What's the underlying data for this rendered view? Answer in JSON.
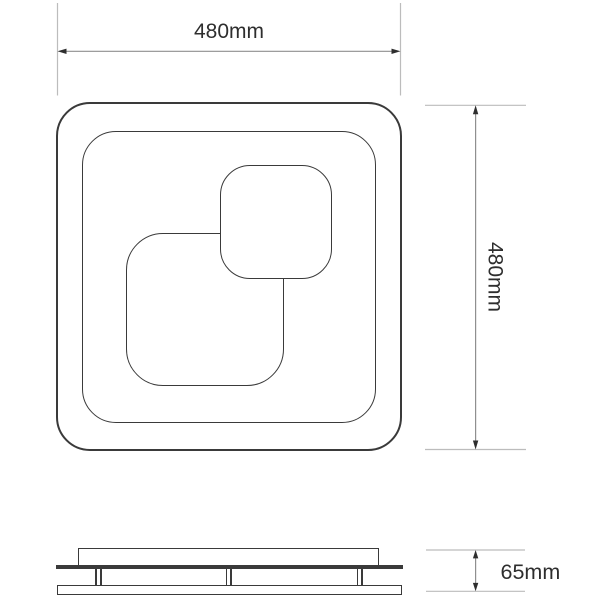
{
  "colors": {
    "background": "#ffffff",
    "outline": "#3a3a3a",
    "dim_line": "#8f8f8f",
    "ext_line": "#bcbcbc",
    "label_text": "#2e2e2e"
  },
  "dimensions": {
    "width": {
      "label": "480mm",
      "value": 480,
      "unit": "mm"
    },
    "height": {
      "label": "480mm",
      "value": 480,
      "unit": "mm"
    },
    "depth": {
      "label": "65mm",
      "value": 65,
      "unit": "mm"
    }
  }
}
